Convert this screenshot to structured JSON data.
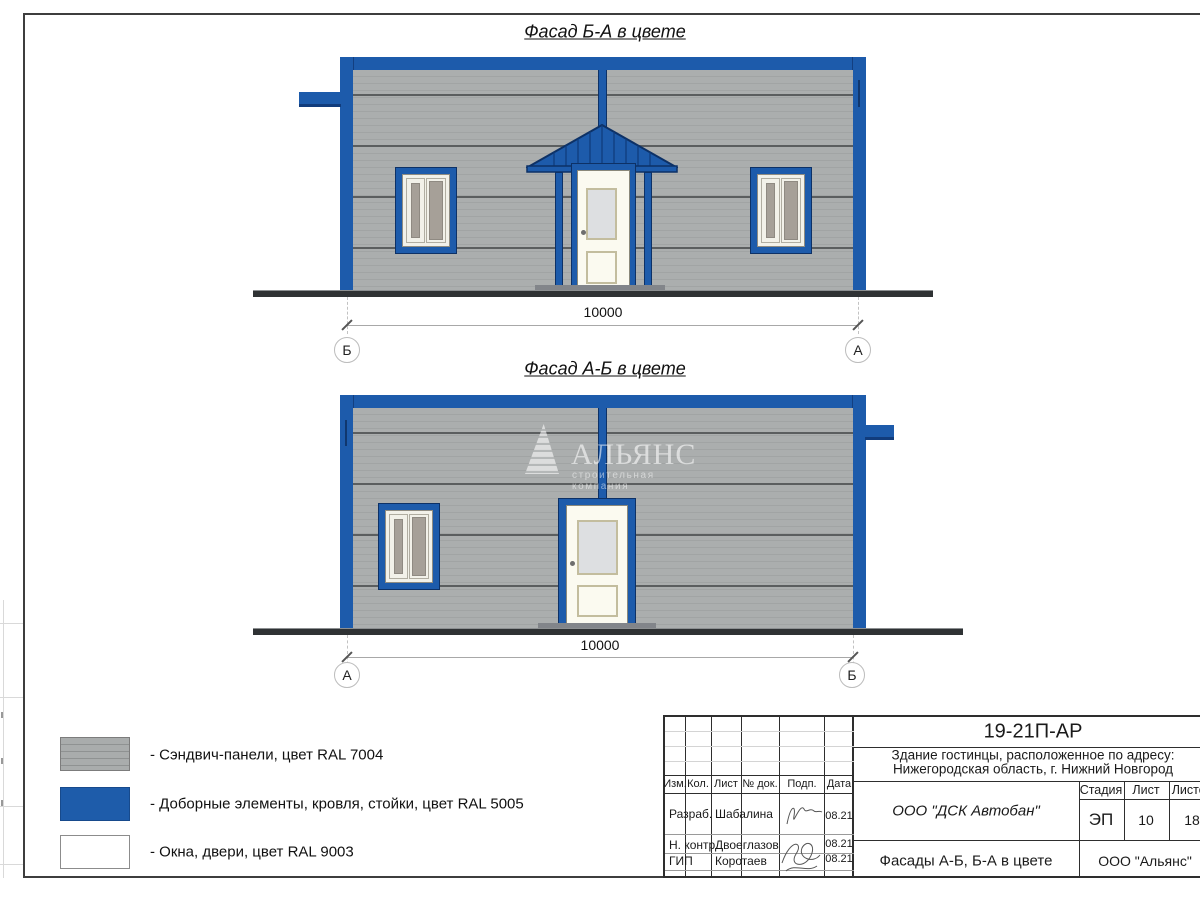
{
  "page": {
    "facade1": {
      "title": "Фасад Б-А в цвете",
      "dim_label": "10000",
      "axis_left": "Б",
      "axis_right": "А"
    },
    "facade2": {
      "title": "Фасад А-Б в цвете",
      "dim_label": "10000",
      "axis_left": "А",
      "axis_right": "Б"
    },
    "watermark": {
      "name": "АЛЬЯНС",
      "subtitle": "строительная компания"
    },
    "legend": {
      "items": [
        {
          "label": "- Сэндвич-панели, цвет RAL 7004",
          "color": "#a9acac"
        },
        {
          "label": "- Доборные элементы, кровля, стойки, цвет RAL 5005",
          "color": "#1e5caa"
        },
        {
          "label": "- Окна, двери, цвет RAL 9003",
          "color": "#ffffff"
        }
      ]
    },
    "titleblock": {
      "doc_number": "19-21П-АР",
      "project_line1": "Здание гостинцы, расположенное по адресу:",
      "project_line2": "Нижегородская область, г. Нижний Новгород",
      "col_headers": {
        "izm": "Изм.",
        "kol": "Кол.",
        "list": "Лист",
        "doc": "№ док.",
        "podp": "Подп.",
        "date": "Дата"
      },
      "rows": [
        {
          "role": "Разраб.",
          "name": "Шабалина",
          "date": "08.21"
        },
        {
          "role": "Н. контр.",
          "name": "Двоеглазов",
          "date": "08.21"
        },
        {
          "role": "ГИП",
          "name": "Коротаев",
          "date": "08.21"
        }
      ],
      "contractor": "ООО \"ДСК Автобан\"",
      "stage_header": "Стадия",
      "sheet_header": "Лист",
      "sheets_header": "Листов",
      "stage": "ЭП",
      "sheet_no": "10",
      "sheets_total": "18",
      "drawing_title": "Фасады А-Б, Б-А в цвете",
      "org": "ООО \"Альянс\""
    }
  }
}
